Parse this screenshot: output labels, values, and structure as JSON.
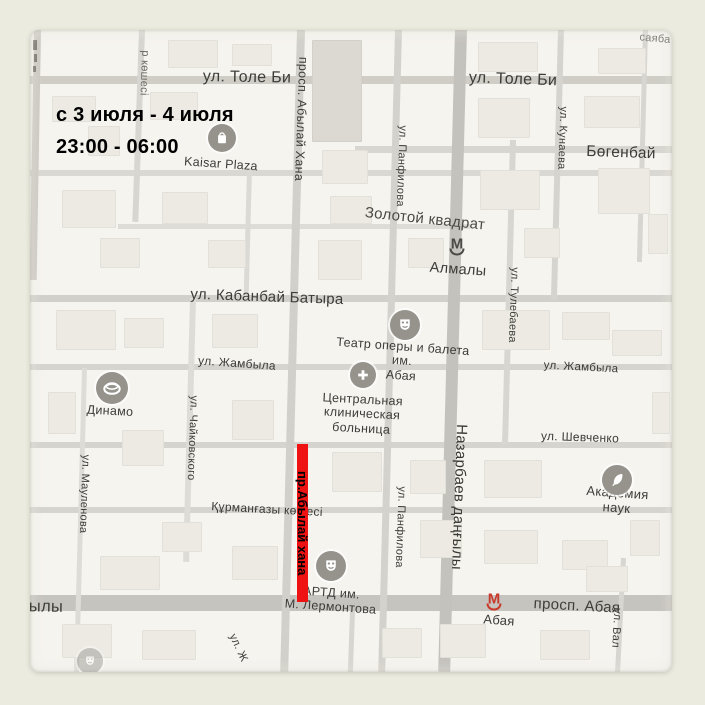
{
  "annotation": {
    "line1": "с 3 июля - 4 июля",
    "line2": "23:00 - 06:00"
  },
  "closure": {
    "label": "пр.Абылай хана",
    "color": "#ee1212"
  },
  "map": {
    "background": "#f6f4ef",
    "frame_background": "#ecebe0",
    "labels": [
      {
        "id": "tole-bi-left",
        "text": "ул. Толе Би",
        "kind": "street"
      },
      {
        "id": "tole-bi-right",
        "text": "ул. Толе Би",
        "kind": "street"
      },
      {
        "id": "sayaba",
        "text": "саяба",
        "kind": "park"
      },
      {
        "id": "abylai-khana",
        "text": "просп. Абылай Хана",
        "kind": "street"
      },
      {
        "id": "r-koshesi",
        "text": "р көшесі",
        "kind": "street"
      },
      {
        "id": "panfilova-top",
        "text": "ул. Панфилова",
        "kind": "street"
      },
      {
        "id": "panfilova-bottom",
        "text": "ул. Панфилова",
        "kind": "street"
      },
      {
        "id": "kunaeva",
        "text": "ул. Кунаева",
        "kind": "street"
      },
      {
        "id": "bogenbai",
        "text": "Бөгенбай",
        "kind": "street"
      },
      {
        "id": "zolotoy-kvadrat",
        "text": "Золотой квадрат",
        "kind": "district"
      },
      {
        "id": "almaly-metro-label",
        "text": "Алмалы",
        "kind": "metro"
      },
      {
        "id": "tulebaeva",
        "text": "ул. Тулебаева",
        "kind": "street"
      },
      {
        "id": "kabanbai-batyra",
        "text": "ул. Кабанбай Батыра",
        "kind": "street"
      },
      {
        "id": "opera-theatre",
        "text": "Театр оперы и балета\nим.\nАбая",
        "kind": "poi"
      },
      {
        "id": "zhambyla-left",
        "text": "ул. Жамбыла",
        "kind": "street"
      },
      {
        "id": "zhambyla-right",
        "text": "ул. Жамбыла",
        "kind": "street"
      },
      {
        "id": "hospital",
        "text": "Центральная\nклиническая\nбольница",
        "kind": "poi"
      },
      {
        "id": "dinamo",
        "text": "Динамо",
        "kind": "poi"
      },
      {
        "id": "chaikovskogo",
        "text": "ул. Чайковского",
        "kind": "street"
      },
      {
        "id": "maulenova",
        "text": "ул. Мауленова",
        "kind": "street"
      },
      {
        "id": "shevchenko",
        "text": "ул. Шевченко",
        "kind": "street"
      },
      {
        "id": "nazarbaev",
        "text": "Назарбаев даңғылы",
        "kind": "street"
      },
      {
        "id": "akademia-nauk",
        "text": "Академия наук",
        "kind": "poi"
      },
      {
        "id": "kurmangazy",
        "text": "Құрманғазы көшесі",
        "kind": "street"
      },
      {
        "id": "artd",
        "text": "АРТД им.\nМ. Лермонтова",
        "kind": "poi"
      },
      {
        "id": "yly",
        "text": "ылы",
        "kind": "street"
      },
      {
        "id": "prosp-abaya",
        "text": "просп. Абая",
        "kind": "street"
      },
      {
        "id": "abaya-metro-label",
        "text": "Абая",
        "kind": "metro"
      },
      {
        "id": "ul-val",
        "text": "ул. Вал",
        "kind": "street"
      },
      {
        "id": "ul-zh",
        "text": "ул. Ж",
        "kind": "street"
      },
      {
        "id": "kaisar-plaza",
        "text": "Kaisar Plaza",
        "kind": "poi"
      }
    ],
    "pois": [
      {
        "id": "kaisar-plaza-icon",
        "icon": "shopping-bag-icon"
      },
      {
        "id": "opera-theatre-icon",
        "icon": "theater-mask-icon"
      },
      {
        "id": "hospital-icon",
        "icon": "medical-cross-icon"
      },
      {
        "id": "dinamo-icon",
        "icon": "stadium-icon"
      },
      {
        "id": "akademia-icon",
        "icon": "quill-icon"
      },
      {
        "id": "artd-icon",
        "icon": "theater-mask-icon"
      },
      {
        "id": "faded-icon",
        "icon": "theater-mask-icon"
      }
    ],
    "metro_stations": [
      {
        "id": "almaly",
        "glyph": "М",
        "color": "#4b4a46"
      },
      {
        "id": "abaya",
        "glyph": "М",
        "color": "#c9392c"
      }
    ]
  }
}
